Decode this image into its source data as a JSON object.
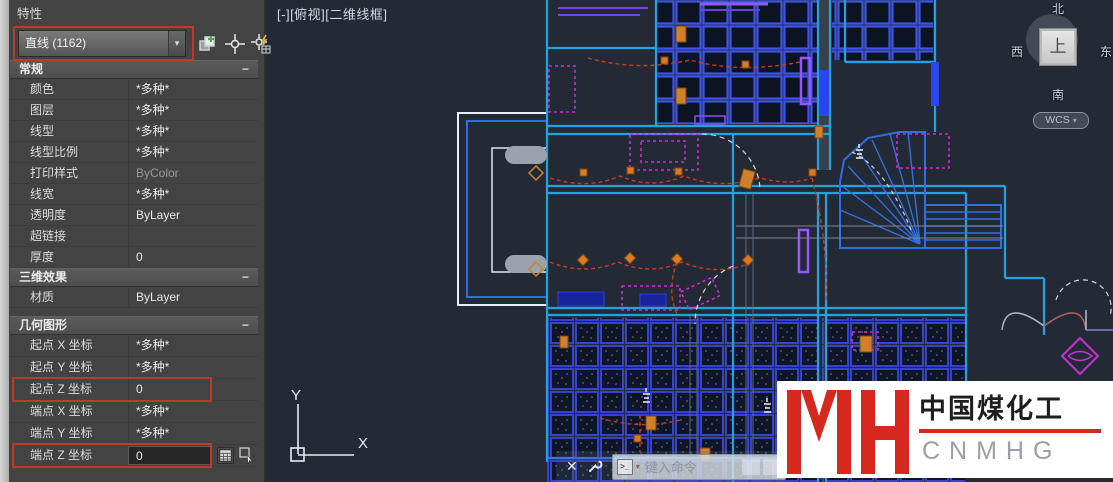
{
  "panel": {
    "title": "特性",
    "selector": {
      "value": "直线 (1162)",
      "arrow": "▾"
    },
    "toolbar_icons": [
      "pickadd-toggle-icon",
      "select-objects-icon",
      "quick-select-icon"
    ],
    "sections": [
      {
        "title": "常规",
        "collapse_glyph": "−",
        "rows": [
          {
            "label": "颜色",
            "value": "*多种*"
          },
          {
            "label": "图层",
            "value": "*多种*"
          },
          {
            "label": "线型",
            "value": "*多种*"
          },
          {
            "label": "线型比例",
            "value": "*多种*"
          },
          {
            "label": "打印样式",
            "value": "ByColor",
            "dim": true
          },
          {
            "label": "线宽",
            "value": "*多种*"
          },
          {
            "label": "透明度",
            "value": "ByLayer"
          },
          {
            "label": "超链接",
            "value": ""
          },
          {
            "label": "厚度",
            "value": "0"
          }
        ]
      },
      {
        "title": "三维效果",
        "collapse_glyph": "−",
        "rows": [
          {
            "label": "材质",
            "value": "ByLayer"
          }
        ]
      },
      {
        "title": "几何图形",
        "collapse_glyph": "−",
        "rows": [
          {
            "label": "起点 X 坐标",
            "value": "*多种*"
          },
          {
            "label": "起点 Y 坐标",
            "value": "*多种*"
          },
          {
            "label": "起点 Z 坐标",
            "value": "0",
            "highlight": true
          },
          {
            "label": "端点 X 坐标",
            "value": "*多种*"
          },
          {
            "label": "端点 Y 坐标",
            "value": "*多种*"
          },
          {
            "label": "端点 Z 坐标",
            "value": "0",
            "highlight": true,
            "editing": true,
            "icons": [
              "calculator-icon",
              "pick-point-icon"
            ]
          }
        ]
      }
    ]
  },
  "viewport": {
    "view_label": {
      "controls": "[-]",
      "view": "[俯视]",
      "style": "[二维线框]"
    },
    "viewcube": {
      "north": "北",
      "south": "南",
      "west": "西",
      "east": "东",
      "top": "上",
      "wcs_label": "WCS",
      "wcs_arrow": "▾"
    },
    "ucs": {
      "x_label": "X",
      "y_label": "Y"
    },
    "command_bar": {
      "close_glyph": "✕",
      "prompt_glyph": ">_",
      "placeholder": "键入命令"
    }
  },
  "watermark": {
    "company": "中国煤化工",
    "abbr": "CNMHG"
  },
  "colors": {
    "annotation_red": "#c0392b",
    "wall_cyan": "#21a3e0",
    "tile_blue": "#3a50d8",
    "furniture_magenta": "#d428d4",
    "wire_red": "#cc3a24",
    "device_orange": "#d08028",
    "canvas_bg": "#232a36",
    "panel_bg": "#434343",
    "logo_red": "#d6281e"
  }
}
